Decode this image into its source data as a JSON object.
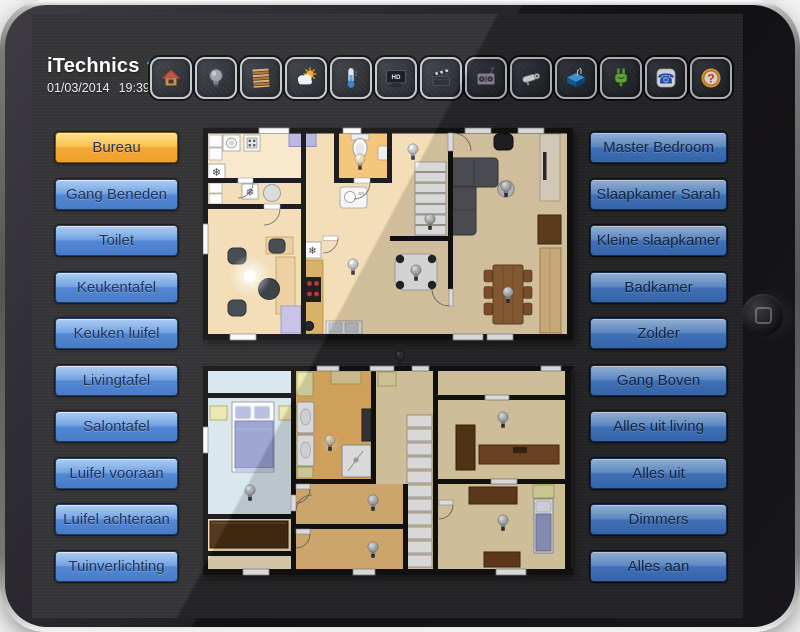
{
  "header": {
    "app_name": "iTechnics",
    "date": "01/03/2014",
    "time": "19:39"
  },
  "toolbar": {
    "icons": [
      {
        "name": "home"
      },
      {
        "name": "light-bulb"
      },
      {
        "name": "window-blinds"
      },
      {
        "name": "weather"
      },
      {
        "name": "thermometer"
      },
      {
        "name": "tv",
        "label": "HD"
      },
      {
        "name": "movie-clapper"
      },
      {
        "name": "audio-system",
        "glyph": "♪"
      },
      {
        "name": "security-camera"
      },
      {
        "name": "swimming-pool"
      },
      {
        "name": "power-plug"
      },
      {
        "name": "telephone",
        "glyph": "☎"
      },
      {
        "name": "help",
        "glyph": "?"
      }
    ]
  },
  "left_buttons": [
    {
      "label": "Bureau",
      "active": true
    },
    {
      "label": "Gang Beneden"
    },
    {
      "label": "Toilet"
    },
    {
      "label": "Keukentafel"
    },
    {
      "label": "Keuken luifel"
    },
    {
      "label": "Livingtafel"
    },
    {
      "label": "Salontafel"
    },
    {
      "label": "Luifel vooraan"
    },
    {
      "label": "Luifel achteraan"
    },
    {
      "label": "Tuinverlichting"
    }
  ],
  "right_buttons": [
    {
      "label": "Master Bedroom"
    },
    {
      "label": "Slaapkamer Sarah"
    },
    {
      "label": "Kleine slaapkamer"
    },
    {
      "label": "Badkamer"
    },
    {
      "label": "Zolder"
    },
    {
      "label": "Gang Boven"
    },
    {
      "label": "Alles uit living"
    },
    {
      "label": "Alles uit"
    },
    {
      "label": "Dimmers"
    },
    {
      "label": "Alles aan"
    }
  ],
  "floorplan": {
    "snowflake_glyph": "❄",
    "floors": [
      "ground",
      "upper"
    ],
    "lit_rooms": [
      "Bureau",
      "Toilet",
      "Badkamer"
    ]
  },
  "colors": {
    "button_blue": "#4a82d4",
    "active_orange": "#f2a32a",
    "screen_bg": "#2a2a2c",
    "wifi_blue": "#35a2f5"
  }
}
